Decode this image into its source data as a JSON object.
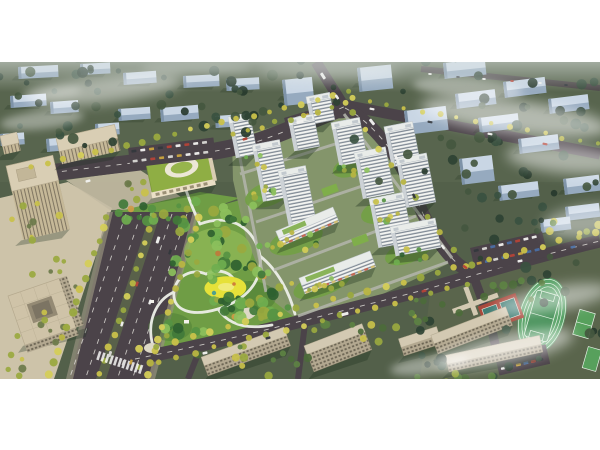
{
  "scene": {
    "type": "aerial-architectural-rendering",
    "description": "Bird's-eye rendering of a residential development: white residential towers around green courtyards, a large central park with winding white paths and a yellow lawn, a kindergarten with a green roof and oval courtyard, a tree-lined boulevard, a school campus with running track and sport courts, beige office buildings, surrounding city blocks of blue-gray massing under patchy fog",
    "elements": [
      "context-city-blocks",
      "residential-towers",
      "central-park",
      "park-paths",
      "yellow-lawn",
      "kindergarten-green-roof",
      "boulevard",
      "south-road",
      "east-road",
      "north-road",
      "school-buildings",
      "running-track",
      "basketball-courts",
      "tennis-courts",
      "office-buildings",
      "parking-lots",
      "street-trees",
      "cars",
      "fog"
    ]
  },
  "palette": {
    "background": "#ffffff",
    "contextGround": "#53604a",
    "contextGroundFar": "#5d6a52",
    "contextBuildingTop": "#c9d6e4",
    "contextBuildingFront": "#96aabf",
    "contextBuildingEnd": "#7e93a8",
    "road": "#4b4349",
    "median": "#59614a",
    "laneMarking": "#e8e6e0",
    "sidewalk": "#97917f",
    "parkGreen": "#6f9d45",
    "parkGreenDark": "#4a7a33",
    "parkGreenLight": "#93bb58",
    "pathWhite": "#edefe8",
    "plazaLight": "#ddd8c6",
    "lawnYellow": "#e6e139",
    "lawnYellowLight": "#f1ee8a",
    "playTeal": "#4fa08e",
    "playOrange": "#cf7f3a",
    "towerFacade": "#f4f5f2",
    "towerWindow": "#6a7582",
    "towerRoof": "#e9ece9",
    "towerSide": "#cdd2d6",
    "shadow": "#1f3320",
    "compoundGround": "#87986d",
    "courtyardGreen": "#74a047",
    "greenRoof": "#7fae4a",
    "internalStreet": "#b4b5ac",
    "officeBeige": "#c6b998",
    "officeRoof": "#d9ceb4",
    "officeWindow": "#6b6352",
    "plazaBeige": "#cdc3a9",
    "schoolFacade": "#b3a890",
    "schoolWindow": "#5d5748",
    "schoolRoof": "#d3c9b2",
    "schoolGround": "#5a654c",
    "kindergartenRoof": "#8fae44",
    "kindergartenCourt": "#ece7d6",
    "kindergartenInner": "#97b54c",
    "kindergartenFacade": "#eadfc6",
    "sportsField": "#3f8c52",
    "trackGreen": "#4f9d5f",
    "sportLine": "#dff0df",
    "courtRed": "#a8493c",
    "courtTeal": "#3f7d74",
    "courtGreen": "#57a05c",
    "fog": "#ffffff",
    "contextTreeColors": [
      "#2e4233",
      "#3a5140",
      "#27392d",
      "#44573f"
    ],
    "parkTreeColors": [
      "#2f6130",
      "#41793a",
      "#569243",
      "#6fae4f",
      "#8cc05c",
      "#9aa93f"
    ],
    "accentTreeColors": [
      "#bf7a3c",
      "#b85f3f",
      "#d09a46"
    ],
    "streetTreeColors": [
      "#c9c14a",
      "#b8b542",
      "#d4cd58",
      "#9aa93f"
    ],
    "carColors": [
      "#f2f2f0",
      "#33383d",
      "#b54338",
      "#caa43e",
      "#4a6fa5",
      "#d9d9d6"
    ]
  }
}
